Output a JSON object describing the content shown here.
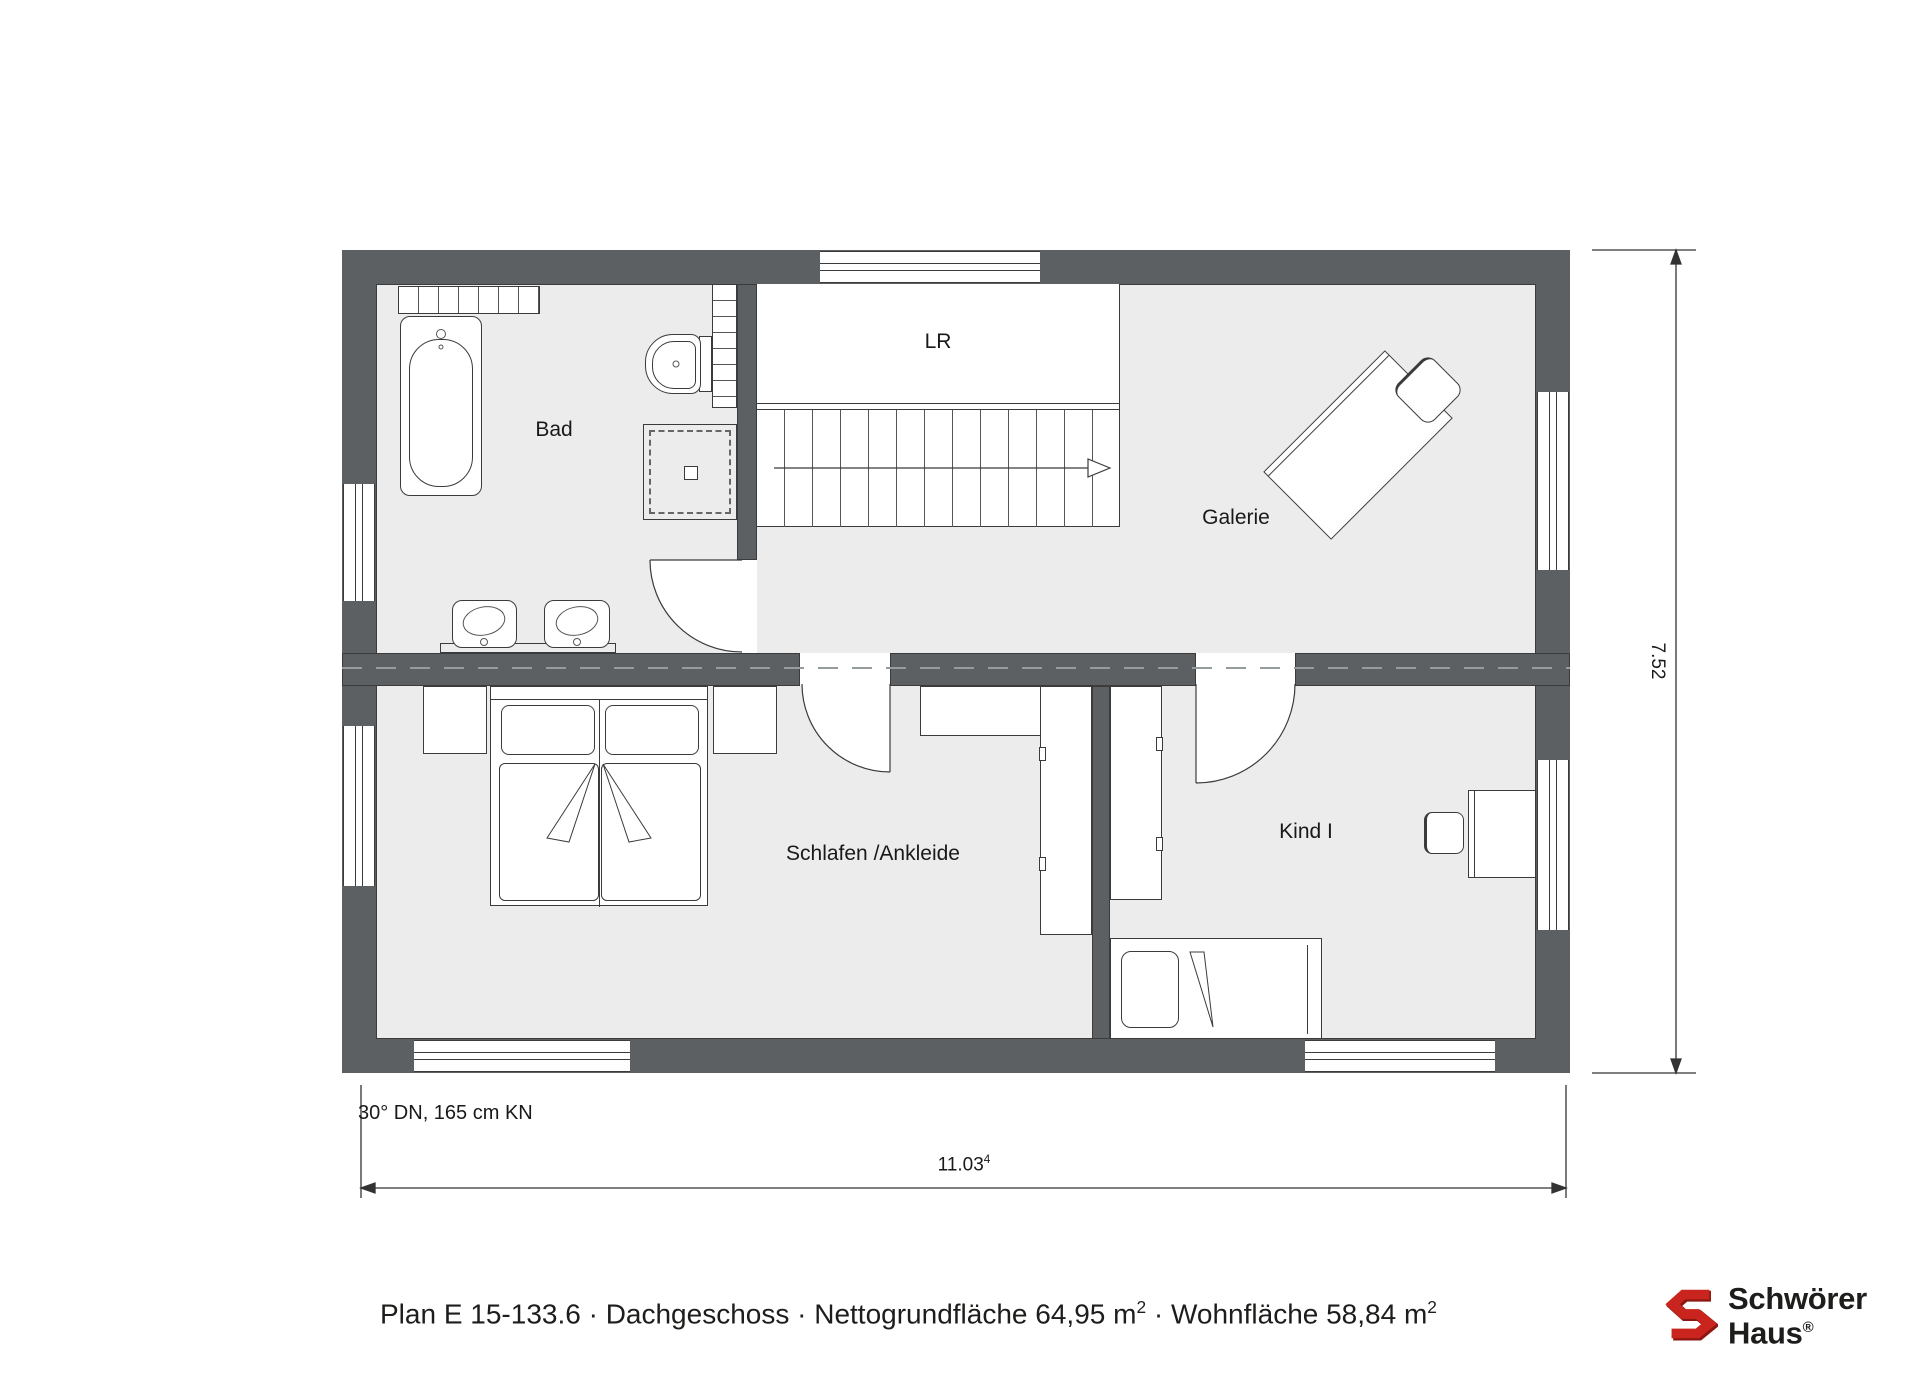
{
  "plan": {
    "room_labels": {
      "bad": "Bad",
      "lr": "LR",
      "galerie": "Galerie",
      "schlafen": "Schlafen /Ankleide",
      "kind": "Kind I"
    },
    "roof_note": "30° DN, 165 cm KN",
    "dimensions": {
      "width": "11.03",
      "width_sup": "4",
      "height": "7.52"
    }
  },
  "caption": {
    "part1": "Plan E 15-133.6 · Dachgeschoss · Nettogrundfläche 64,95 m",
    "sup1": "2",
    "part2": " · Wohnfläche 58,84 m",
    "sup2": "2"
  },
  "logo": {
    "line1": "Schwörer",
    "line2": "Haus",
    "registered": "®"
  },
  "colors": {
    "wall": "#5c6062",
    "floor": "#ececec",
    "line": "#333333",
    "brand_red": "#c9241d",
    "text": "#1d1d1b"
  }
}
